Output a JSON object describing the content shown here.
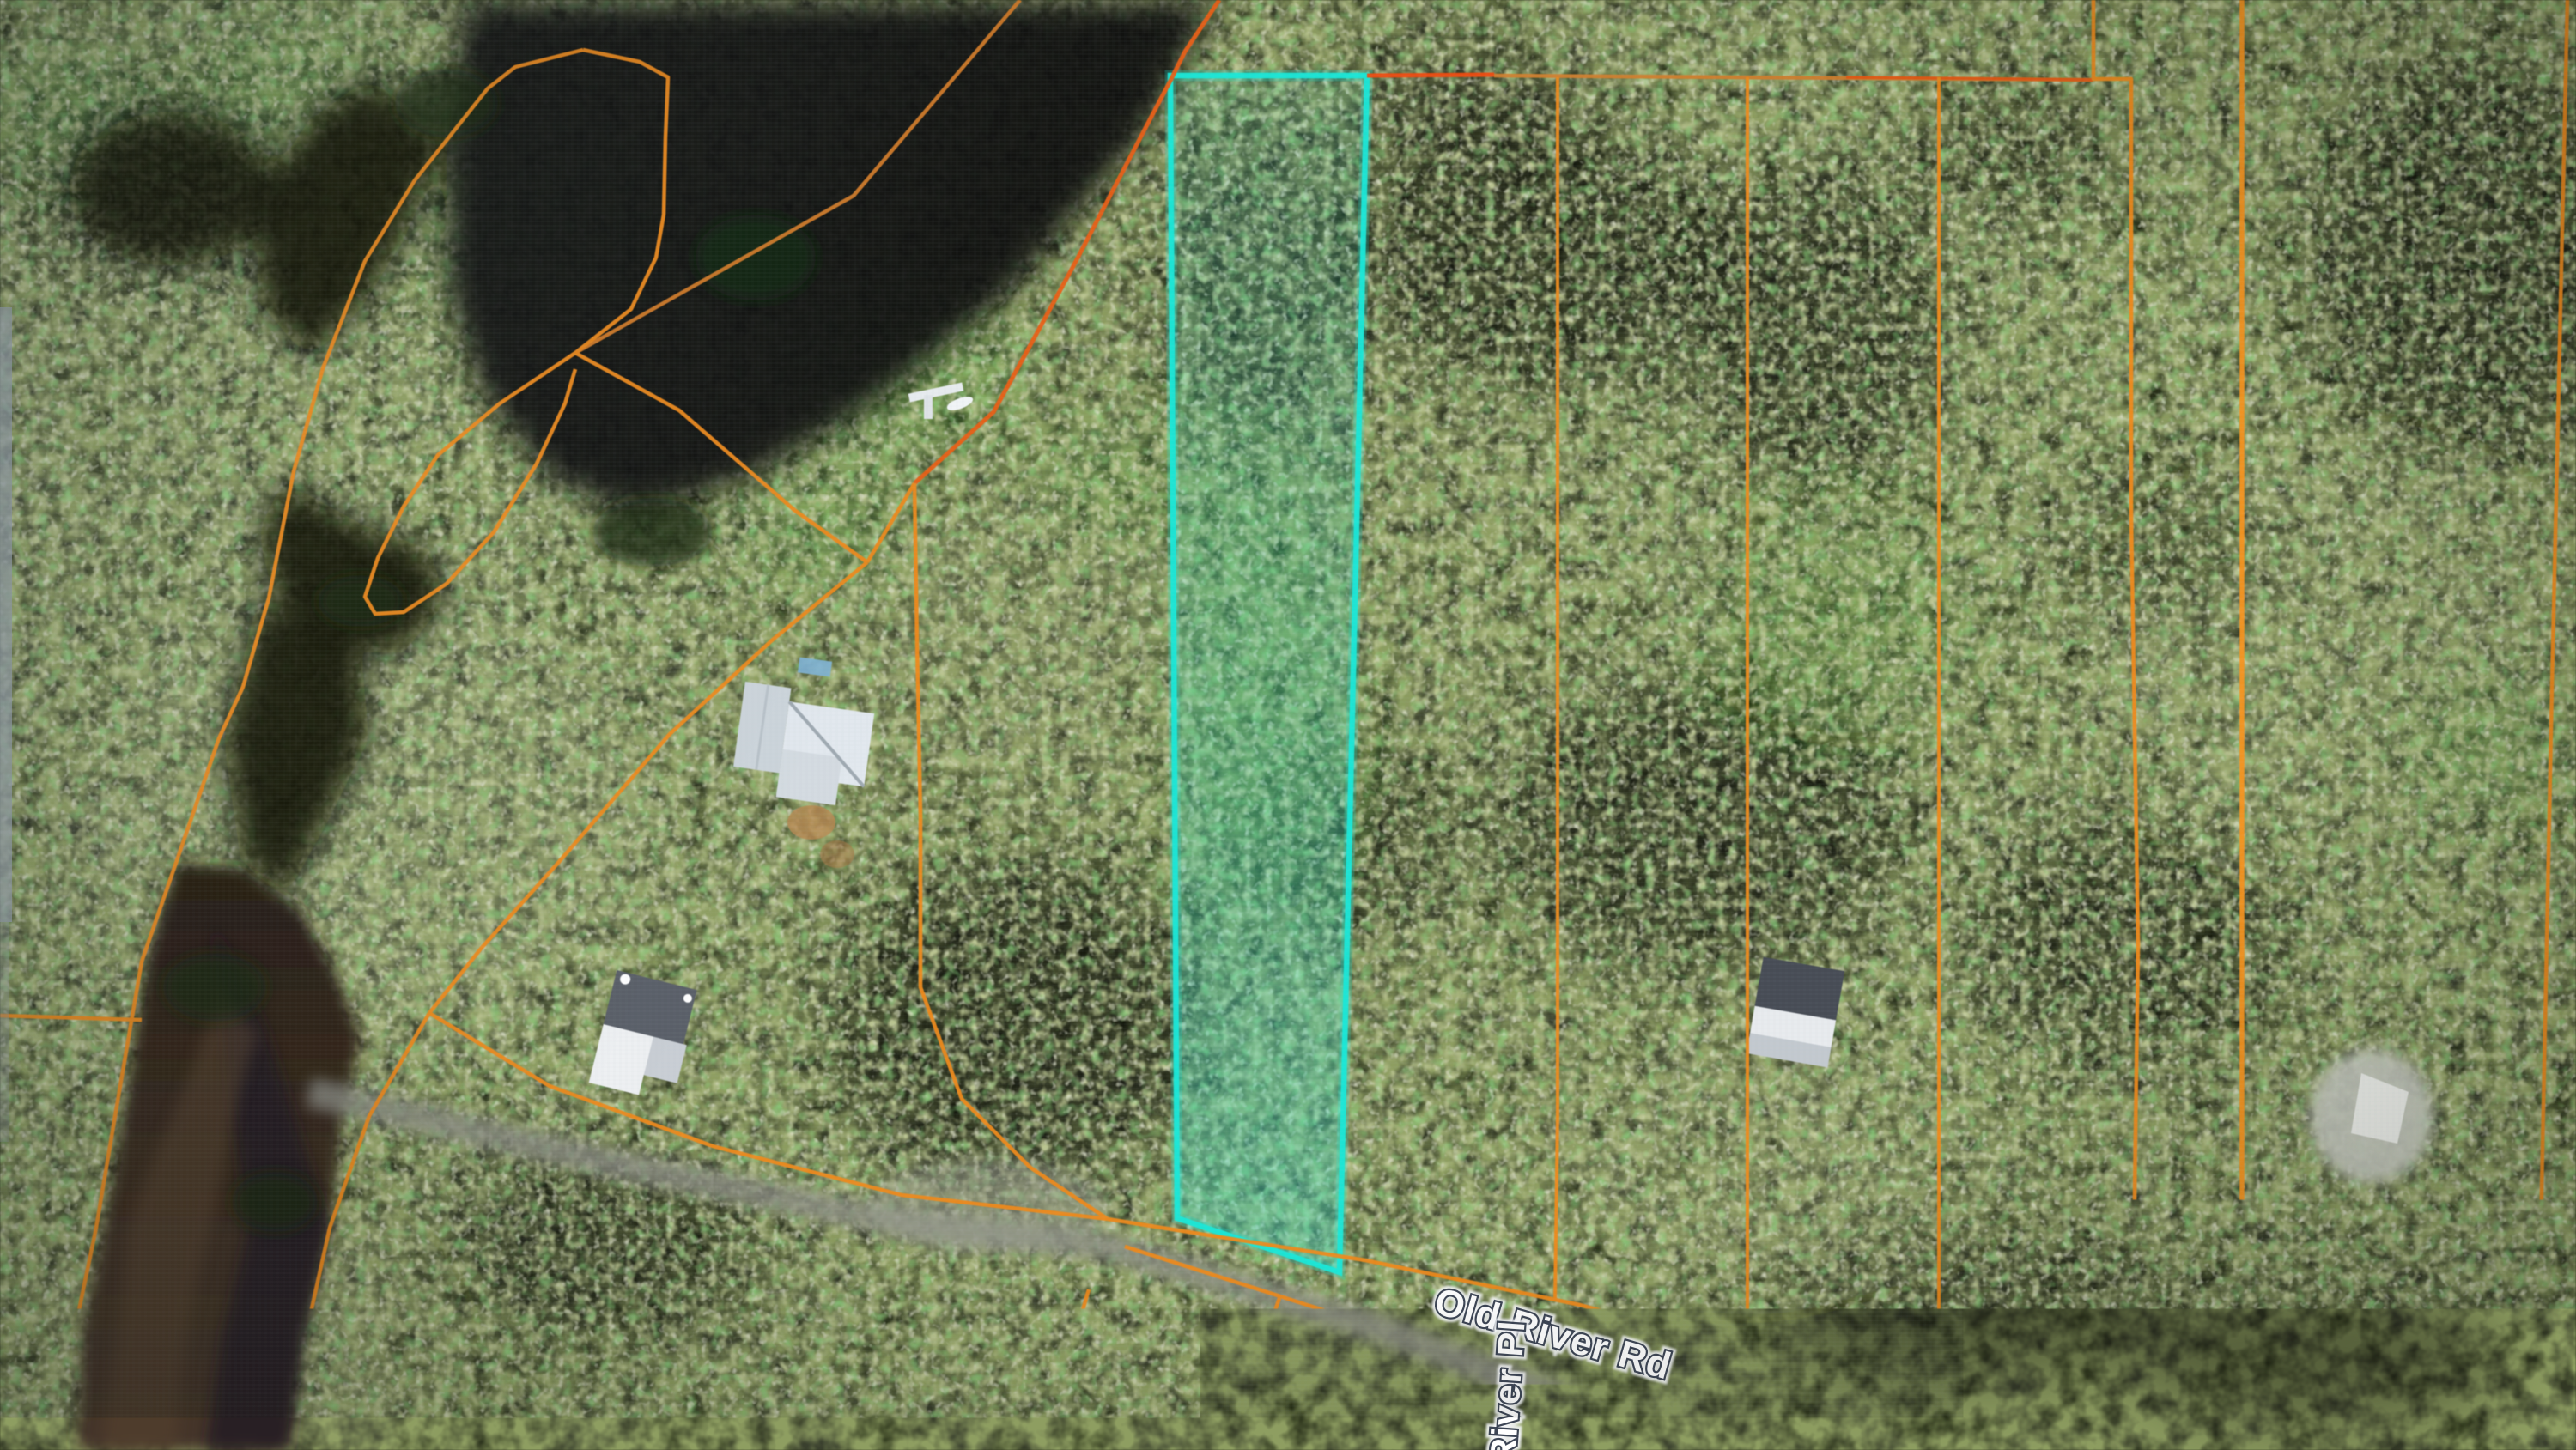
{
  "map": {
    "description": "aerial satellite parcel map with highlighted lot",
    "road_labels": {
      "old_river_rd": "Old River Rd",
      "river_pl": "River Pl"
    },
    "colors": {
      "parcel_line_orange": "#ee8a1c",
      "parcel_line_red_orange": "#e95f16",
      "selected_parcel_cyan": "#19e8d9",
      "label_text": "#ffffff",
      "label_outline": "#242e40",
      "river_water_brown": "#46362a",
      "road_pavement": "#8b8c82"
    }
  }
}
